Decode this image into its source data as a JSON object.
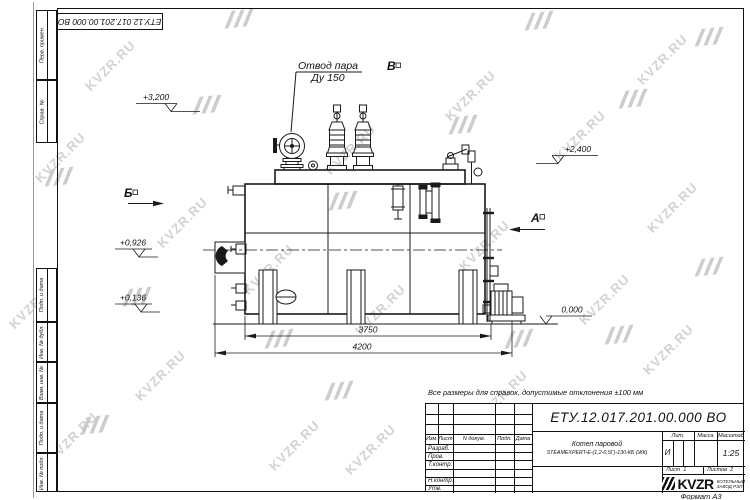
{
  "doc_number": "ЕТУ.12.017.201.00.000  ВО",
  "watermark": {
    "text": "KVZR.RU"
  },
  "note": "Все размеры для справок, допустимые отклонения ±100 мм",
  "frame": {
    "side_labels": [
      "Перв. примен.",
      "Справ. №",
      "Подп. и дата",
      "Инв. № дубл.",
      "Взам. инв. №",
      "Подп. и дата",
      "Инв. № подл."
    ],
    "format_label": "Формат А3"
  },
  "drawing": {
    "callout": {
      "line1": "Отвод пара",
      "line2": "Ду 150"
    },
    "views": {
      "b": "Б",
      "a": "А",
      "v": "В"
    },
    "elevations": {
      "e3200": "+3,200",
      "e2400": "+2,400",
      "e0926": "+0,926",
      "e0136": "+0,136",
      "e0000": "0,000"
    },
    "dimensions": {
      "inner": "3750",
      "outer": "4200"
    }
  },
  "title_block": {
    "product_line1": "Котел паровой",
    "product_line2": "STEAMEXPERT-Е-(1,2-0,5Г)-130-КБ (ЖК)",
    "cols": {
      "izm": "Изм.",
      "list": "Лист",
      "doc": "N докум.",
      "podp": "Подп.",
      "data": "Дата"
    },
    "rows": {
      "r1": "Разраб.",
      "r2": "Пров.",
      "r3": "Т.контр.",
      "r5": "Н.контр.",
      "r6": "Утв."
    },
    "lit_label": "Лит.",
    "lit_value": "И",
    "mass_label": "Масса",
    "scale_label": "Масштаб",
    "scale_value": "1:25",
    "sheet_label": "Лист",
    "sheet_value": "1",
    "sheets_label": "Листов",
    "sheets_value": "2",
    "brand": "KVZR",
    "brand_sub1": "КОТЕЛЬНЫЙ",
    "brand_sub2": "ЗАВОД РЭП"
  }
}
